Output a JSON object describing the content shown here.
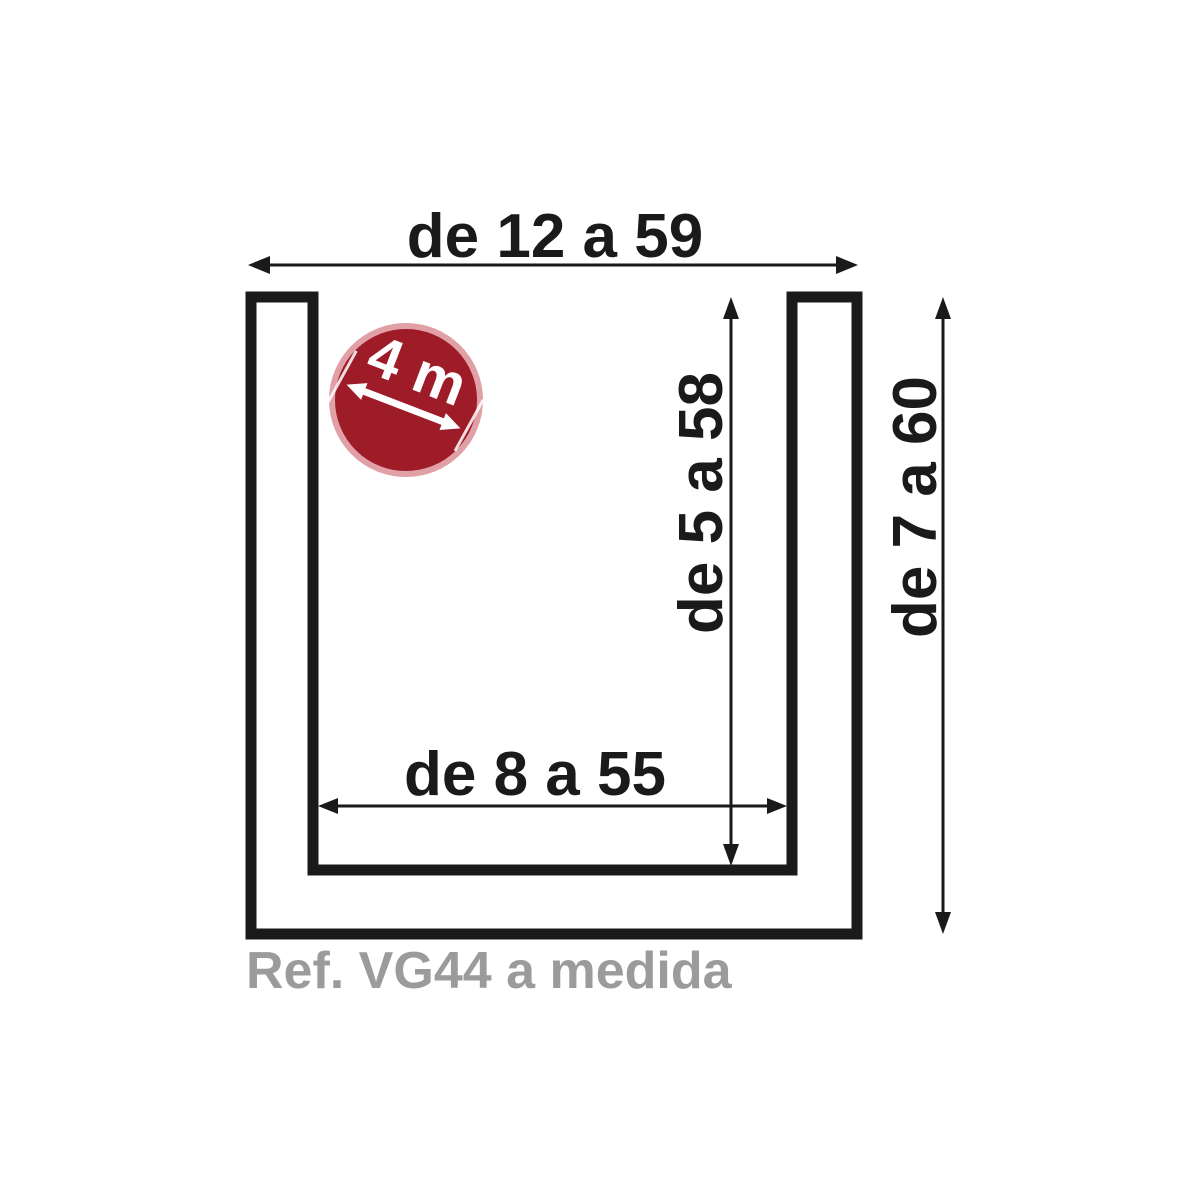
{
  "diagram": {
    "reference": "Ref. VG44 a medida",
    "dimensions": {
      "outer_width": "de 12 a 59",
      "inner_width": "de 8 a 55",
      "inner_height": "de 5 a 58",
      "outer_height": "de 7 a 60"
    },
    "badge": {
      "length": "4 m"
    },
    "colors": {
      "line": "#1a1a1a",
      "badge_fill": "#9e1b28",
      "badge_ring": "#e0a0a6",
      "badge_text": "#ffffff",
      "reference_text": "#9b9b9d",
      "background": "#ffffff"
    }
  }
}
